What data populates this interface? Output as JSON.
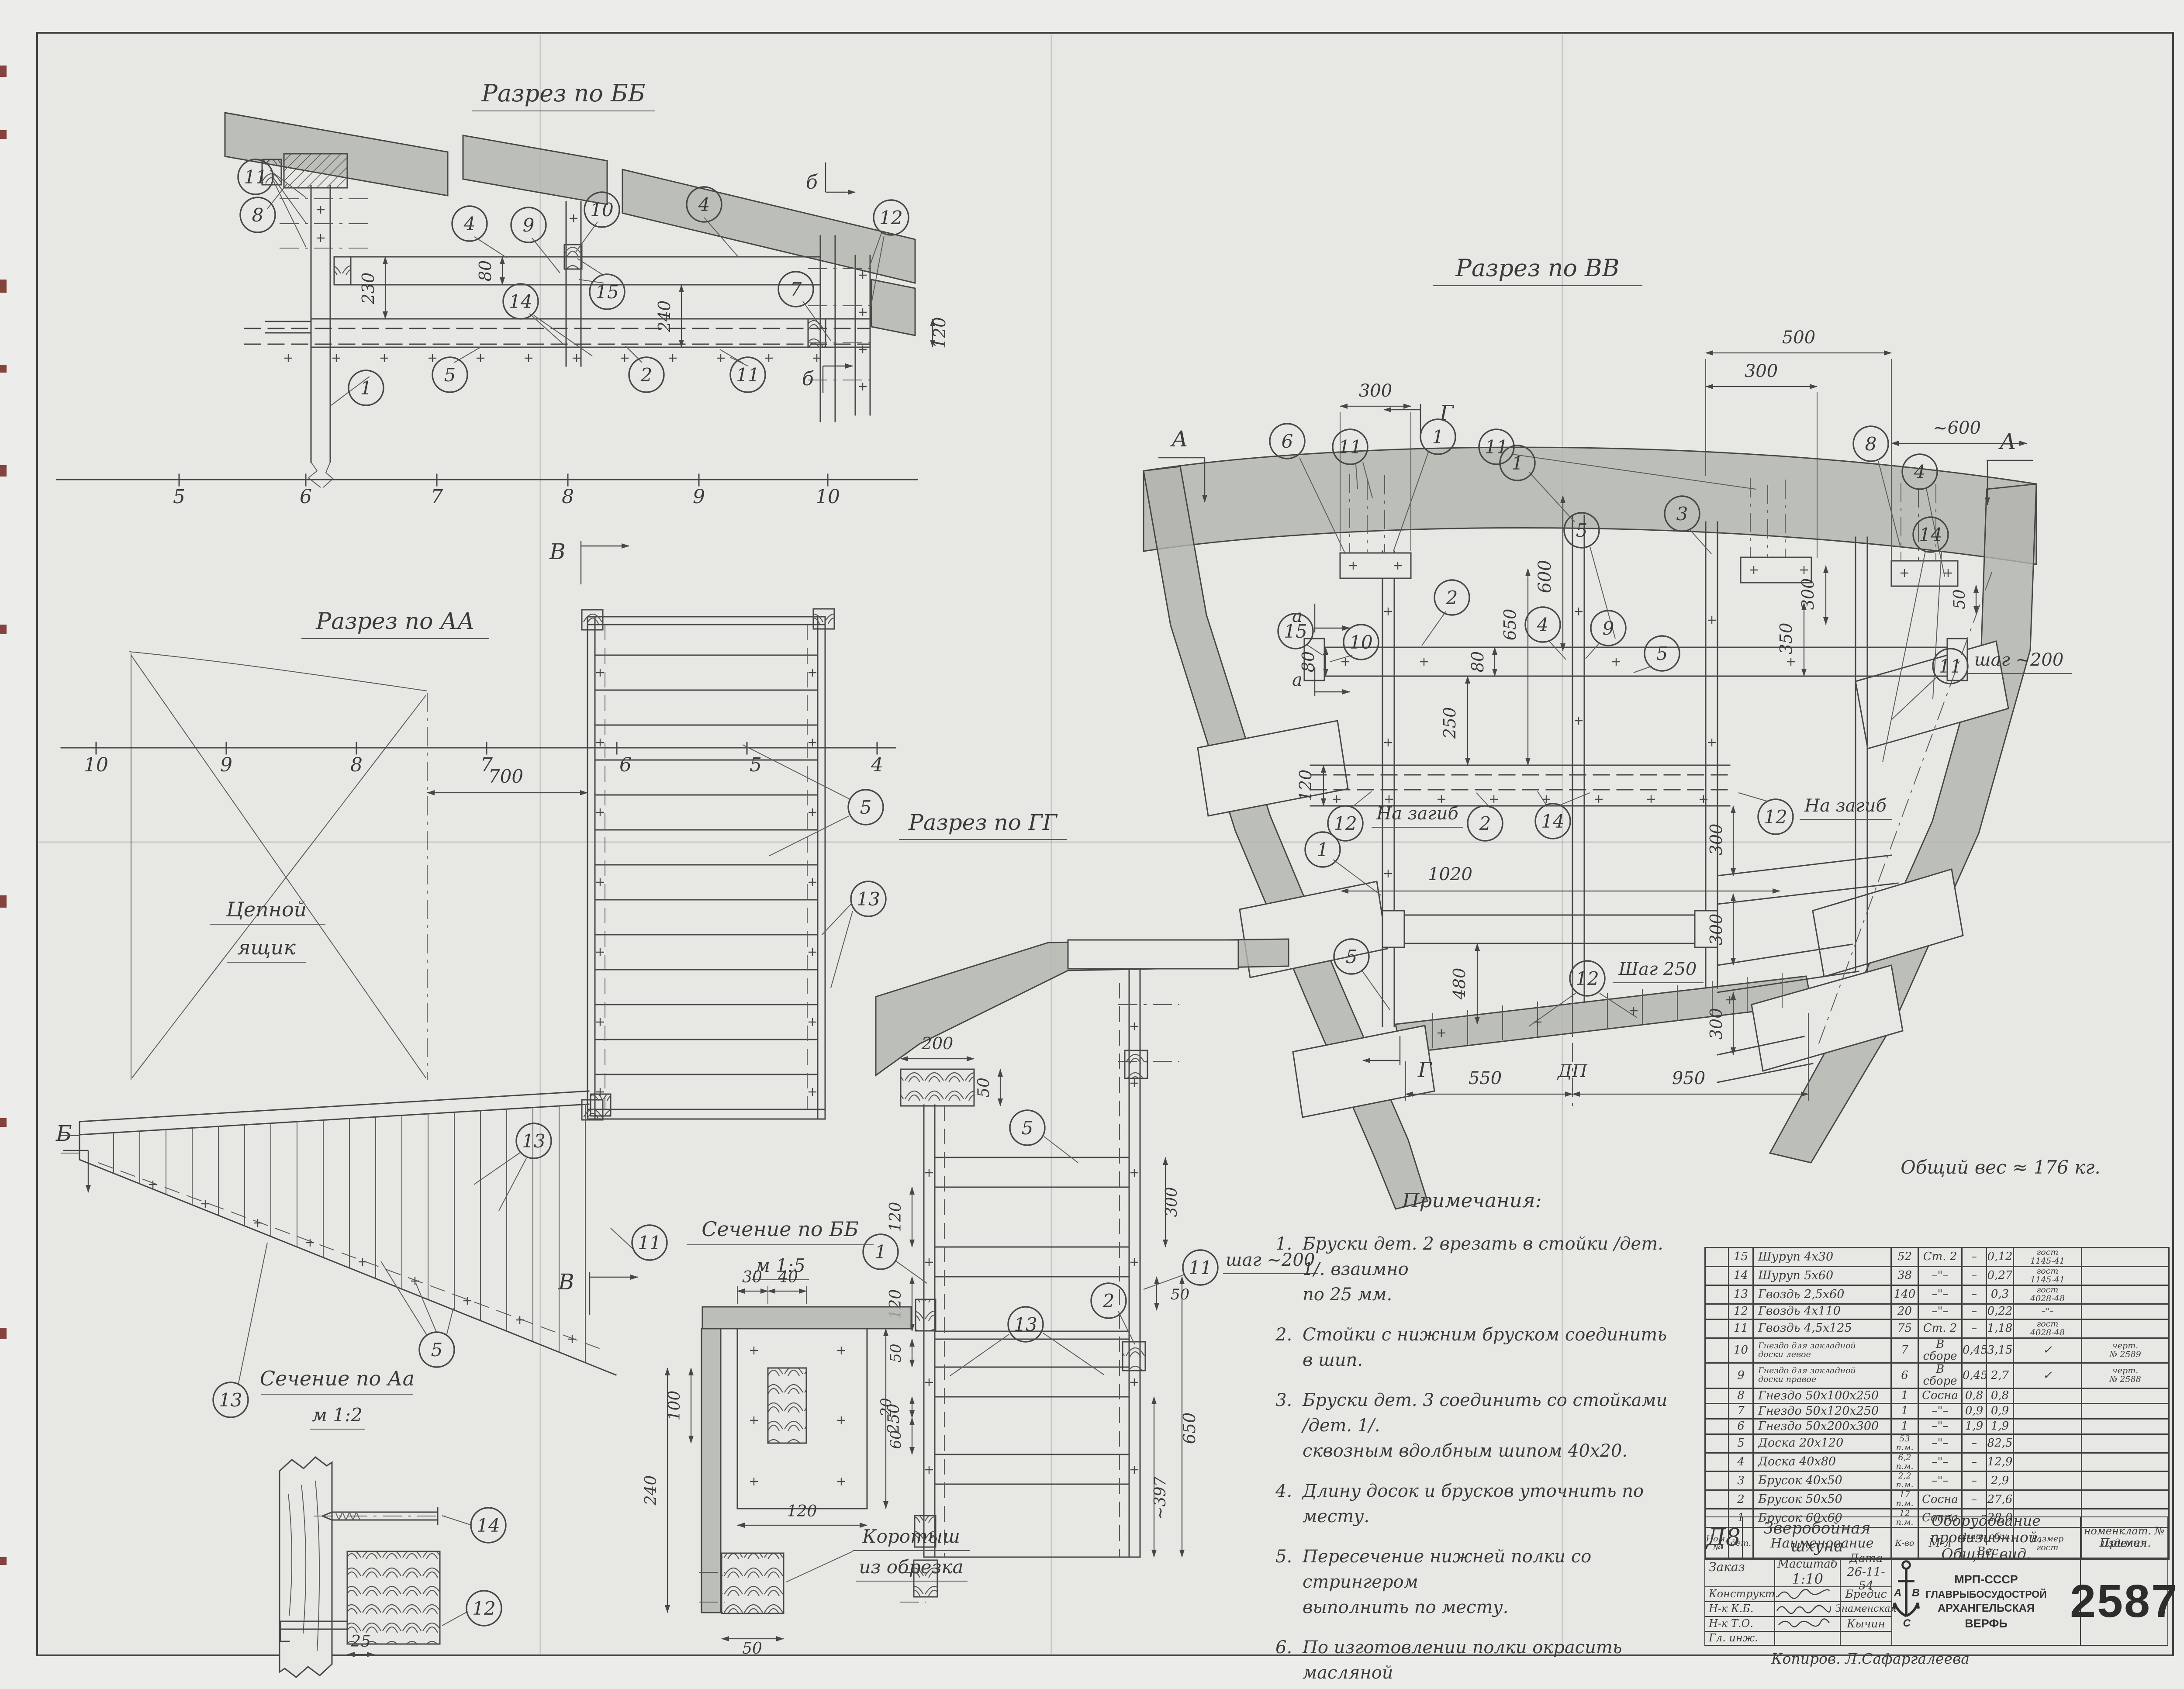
{
  "sheet": {
    "number": "2587",
    "weight_note": "Общий вес ≈ 176 кг."
  },
  "views": {
    "bb": {
      "title": "Разрез по ББ",
      "axis": [
        "5",
        "6",
        "7",
        "8",
        "9",
        "10"
      ],
      "dims": {
        "h80": "80",
        "g230": "230",
        "g240": "240",
        "s120": "120"
      },
      "marks": {
        "b1": "б",
        "b2": "б"
      },
      "callouts": {
        "c11a": "11",
        "c8": "8",
        "c4a": "4",
        "c9": "9",
        "c10": "10",
        "c15": "15",
        "c4b": "4",
        "c7": "7",
        "c12": "12",
        "c14": "14",
        "c5": "5",
        "c2": "2",
        "c11b": "11",
        "c1": "1"
      }
    },
    "aa": {
      "title": "Разрез по АА",
      "axis": [
        "10",
        "9",
        "8",
        "7",
        "6",
        "5",
        "4"
      ],
      "dim700": "700",
      "locker": [
        "Цепной",
        "ящик"
      ],
      "marks": {
        "v_top": "В",
        "v_bot": "В",
        "b": "Б"
      },
      "callouts": {
        "c5": "5",
        "c13": "13",
        "s13a": "13",
        "s11": "11",
        "s5": "5",
        "s13b": "13"
      }
    },
    "vv": {
      "title": "Разрез по ВВ",
      "dims": {
        "d500": "500",
        "d300a": "300",
        "d300b": "300",
        "d600t": "~600",
        "d600": "600",
        "d80a": "80",
        "d80b": "80",
        "d250": "250",
        "d650": "650",
        "d120": "120",
        "d350": "350",
        "d300r": "300",
        "d50r": "50",
        "d1020": "1020",
        "d480": "480",
        "d300r1": "300",
        "d300r2": "300",
        "d300r3": "300",
        "d550": "550",
        "d950": "950"
      },
      "texts": {
        "dp": "ДП",
        "shag250": "Шаг 250",
        "shag200": "шаг ~200",
        "nazagib1": "На загиб",
        "nazagib2": "На загиб"
      },
      "marks": {
        "g1": "Г",
        "g2": "Г",
        "a1": "А",
        "a2": "А",
        "aa1": "а",
        "aa2": "а"
      },
      "callouts": {
        "t6": "6",
        "t11a": "11",
        "t1a": "1",
        "t11b": "11",
        "t1b": "1",
        "t8": "8",
        "t4a": "4",
        "t3": "3",
        "t5a": "5",
        "t14a": "14",
        "m15": "15",
        "m10": "10",
        "m2a": "2",
        "m4b": "4",
        "m9": "9",
        "m5b": "5",
        "s12a": "12",
        "s2b": "2",
        "s14b": "14",
        "s12b": "12",
        "s1c": "1",
        "b5d": "5",
        "b12c": "12",
        "b11c": "11"
      }
    },
    "gg": {
      "title": "Разрез по ГГ",
      "shag200": "шаг ~200",
      "dims": {
        "d200": "200",
        "d50t": "50",
        "d300": "300",
        "d50r": "50",
        "d120a": "120",
        "d120b": "120",
        "d50l": "50",
        "d20": "20",
        "d60": "60",
        "d650": "650",
        "d397": "~397"
      },
      "callouts": {
        "c5": "5",
        "c2": "2",
        "c1": "1",
        "c11": "11",
        "c13": "13"
      }
    },
    "secbb": {
      "title": "Сечение по ББ",
      "scale": "м 1:5",
      "dims": {
        "d30": "30",
        "d40": "40",
        "d100": "100",
        "d240": "240",
        "d250": "250",
        "d120": "120",
        "d50": "50"
      },
      "korotysh": [
        "Коротыш",
        "из обрезка"
      ]
    },
    "secaa": {
      "title": "Сечение по Аа",
      "scale": "м 1:2",
      "dim25": "25",
      "callouts": {
        "c14": "14",
        "c12": "12"
      }
    }
  },
  "notes": {
    "title": "Примечания:",
    "items": [
      {
        "n": "1.",
        "lines": [
          "Бруски дет. 2 врезать в стойки /дет. 1/. взаимно",
          "по 25 мм."
        ]
      },
      {
        "n": "2.",
        "lines": [
          "Стойки с нижним бруском соединить в шип."
        ]
      },
      {
        "n": "3.",
        "lines": [
          "Бруски дет. 3 соединить со стойками /дет. 1/.",
          "сквозным вдолбным шипом 40х20."
        ]
      },
      {
        "n": "4.",
        "lines": [
          "Длину досок и брусков уточнить по месту."
        ]
      },
      {
        "n": "5.",
        "lines": [
          "Пересечение нижней полки со стрингером",
          "выполнить по месту."
        ]
      },
      {
        "n": "6.",
        "lines": [
          "По изготовлении полки окрасить масляной",
          "краской в цвет помещения."
        ]
      }
    ]
  },
  "parts_table": {
    "h": {
      "nom": "Ном.\n№",
      "det": "дет.",
      "name": "Наименование",
      "qty": "К-во",
      "mat": "М-л",
      "w1": "1шт.",
      "w2": "общ.",
      "wes": "Вес",
      "size": "Размер\nгост",
      "note": "Примеч."
    },
    "rows": [
      {
        "pos": "15",
        "name": "Шуруп 4х30",
        "qty": "52",
        "unit": "",
        "mat": "Ст. 2",
        "w1": "–",
        "w2": "0,12",
        "gost": "гост\n1145-41",
        "note": ""
      },
      {
        "pos": "14",
        "name": "Шуруп 5х60",
        "qty": "38",
        "unit": "",
        "mat": "–\"–",
        "w1": "–",
        "w2": "0,27",
        "gost": "гост\n1145-41",
        "note": ""
      },
      {
        "pos": "13",
        "name": "Гвоздь 2,5х60",
        "qty": "140",
        "unit": "",
        "mat": "–\"–",
        "w1": "–",
        "w2": "0,3",
        "gost": "гост\n4028-48",
        "note": ""
      },
      {
        "pos": "12",
        "name": "Гвоздь 4х110",
        "qty": "20",
        "unit": "",
        "mat": "–\"–",
        "w1": "–",
        "w2": "0,22",
        "gost": "–\"–",
        "note": ""
      },
      {
        "pos": "11",
        "name": "Гвоздь 4,5х125",
        "qty": "75",
        "unit": "",
        "mat": "Ст. 2",
        "w1": "–",
        "w2": "1,18",
        "gost": "гост\n4028-48",
        "note": ""
      },
      {
        "pos": "10",
        "name": "Гнездо для закладной\nдоски левое",
        "qty": "7",
        "unit": "",
        "mat": "В сборе",
        "w1": "0,45",
        "w2": "3,15",
        "gost": "✓",
        "note": "черт.\n№ 2589"
      },
      {
        "pos": "9",
        "name": "Гнездо для закладной\nдоски правое",
        "qty": "6",
        "unit": "",
        "mat": "В сборе",
        "w1": "0,45",
        "w2": "2,7",
        "gost": "✓",
        "note": "черт.\n№ 2588"
      },
      {
        "pos": "8",
        "name": "Гнездо 50х100х250",
        "qty": "1",
        "unit": "",
        "mat": "Сосна",
        "w1": "0,8",
        "w2": "0,8",
        "gost": "",
        "note": ""
      },
      {
        "pos": "7",
        "name": "Гнездо 50х120х250",
        "qty": "1",
        "unit": "",
        "mat": "–\"–",
        "w1": "0,9",
        "w2": "0,9",
        "gost": "",
        "note": ""
      },
      {
        "pos": "6",
        "name": "Гнездо 50х200х300",
        "qty": "1",
        "unit": "",
        "mat": "–\"–",
        "w1": "1,9",
        "w2": "1,9",
        "gost": "",
        "note": ""
      },
      {
        "pos": "5",
        "name": "Доска 20х120",
        "qty": "53",
        "unit": "п.м.",
        "mat": "–\"–",
        "w1": "–",
        "w2": "82,5",
        "gost": "",
        "note": ""
      },
      {
        "pos": "4",
        "name": "Доска 40х80",
        "qty": "6,2",
        "unit": "п.м.",
        "mat": "–\"–",
        "w1": "–",
        "w2": "12,9",
        "gost": "",
        "note": ""
      },
      {
        "pos": "3",
        "name": "Брусок 40х50",
        "qty": "2,2",
        "unit": "п.м.",
        "mat": "–\"–",
        "w1": "–",
        "w2": "2,9",
        "gost": "",
        "note": ""
      },
      {
        "pos": "2",
        "name": "Брусок 50х50",
        "qty": "17",
        "unit": "п.м.",
        "mat": "Сосна",
        "w1": "–",
        "w2": "27,6",
        "gost": "",
        "note": ""
      },
      {
        "pos": "1",
        "name": "Брусок 60х60",
        "qty": "12",
        "unit": "п.м.",
        "mat": "Сосна",
        "w1": "–",
        "w2": "28,0",
        "gost": "",
        "note": ""
      }
    ]
  },
  "title_block": {
    "code": "Д8",
    "vessel1": "Зверобойная",
    "vessel2": "шхуна",
    "doc1": "Оборудование провизионной.",
    "doc2": "Общий вид.",
    "nom1": "номенклат. №",
    "nom2": "изделия",
    "order": "Заказ",
    "scale_l": "Масштаб",
    "scale": "1:10",
    "date_l": "Дата",
    "date": "26-11-54",
    "r1": "Конструкт.",
    "n1": "Бредис",
    "r2": "Н-к К.Б.",
    "n2": "Знаменская",
    "r3": "Н-к Т.О.",
    "n3": "Кычин",
    "r4": "Гл. инж.",
    "org1": "МРП-СССР",
    "org2": "ГЛАВРЫБОСУДОСТРОЙ",
    "org3": "АРХАНГЕЛЬСКАЯ",
    "org4": "ВЕРФЬ",
    "logo": [
      "А",
      "С",
      "В"
    ],
    "num": "2587",
    "copier": "Копиров.  Л.Сафаргалеева"
  }
}
